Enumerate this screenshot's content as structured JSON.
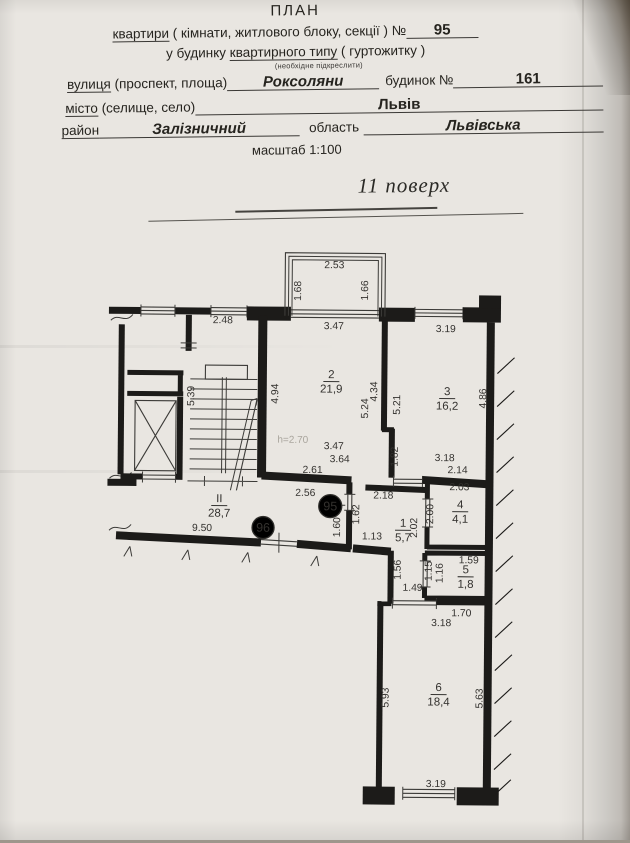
{
  "header": {
    "title": "ПЛАН",
    "apt_word": "квартири",
    "line1_rest": " ( кімнати, житлового блоку, секції ) №",
    "apartment_number": "95",
    "line2_pre": "у будинку ",
    "line2_underlined": "квартирного типу",
    "line2_post": " ( гуртожитку )",
    "line2_note": "(необхідне підкреслити)",
    "street_word": "вулиця",
    "street_label_rest": " (проспект, площа)",
    "street_value": "Роксоляни",
    "building_label": "будинок №",
    "building_value": "161",
    "city_word": "місто",
    "city_label_rest": " (селище, село)",
    "city_value": "Львів",
    "district_word": "район",
    "district_value": "Залізничний",
    "region_label": "область",
    "region_value": "Львівська",
    "scale_label": "масштаб 1:100"
  },
  "floor_title": "11 поверх",
  "plan": {
    "ceiling_height_note": "h=2.70",
    "circles": [
      {
        "t": "95",
        "x": 331,
        "y": 506,
        "r": 11.5
      },
      {
        "t": "96",
        "x": 264,
        "y": 528,
        "r": 11
      }
    ],
    "rooms": [
      {
        "num": "2",
        "area": "21,9",
        "x": 331,
        "y": 378
      },
      {
        "num": "3",
        "area": "16,2",
        "x": 447,
        "y": 394
      },
      {
        "num": "4",
        "area": "4,1",
        "x": 461,
        "y": 507
      },
      {
        "num": "1",
        "area": "5,7",
        "x": 404,
        "y": 526
      },
      {
        "num": "5",
        "area": "1,8",
        "x": 467,
        "y": 572
      },
      {
        "num": "6",
        "area": "18,4",
        "x": 441,
        "y": 690
      },
      {
        "num": "II",
        "area": "28,7",
        "x": 220,
        "y": 503
      }
    ],
    "labels": [
      {
        "t": "2.53",
        "x": 333,
        "y": 268
      },
      {
        "t": "1.68",
        "x": 300,
        "y": 291,
        "r": -90
      },
      {
        "t": "1.66",
        "x": 367,
        "y": 290,
        "r": -90
      },
      {
        "t": "2.48",
        "x": 222,
        "y": 324
      },
      {
        "t": "3.47",
        "x": 333,
        "y": 329
      },
      {
        "t": "3.19",
        "x": 445,
        "y": 331
      },
      {
        "t": "5.39",
        "x": 194,
        "y": 397,
        "r": -90
      },
      {
        "t": "4.94",
        "x": 278,
        "y": 394,
        "r": -90
      },
      {
        "t": "5.24",
        "x": 368,
        "y": 408,
        "r": -90
      },
      {
        "t": "4.34",
        "x": 377,
        "y": 391,
        "r": -90
      },
      {
        "t": "5.21",
        "x": 400,
        "y": 404,
        "r": -90
      },
      {
        "t": "h=2.70",
        "x": 293,
        "y": 443,
        "cls": "faint"
      },
      {
        "t": "3.47",
        "x": 334,
        "y": 449
      },
      {
        "t": "3.64",
        "x": 340,
        "y": 462
      },
      {
        "t": "2.61",
        "x": 313,
        "y": 473
      },
      {
        "t": "2.56",
        "x": 306,
        "y": 496
      },
      {
        "t": "4.86",
        "x": 486,
        "y": 397,
        "r": -90
      },
      {
        "t": "1.82",
        "x": 398,
        "y": 456,
        "r": -90
      },
      {
        "t": "3.18",
        "x": 445,
        "y": 460
      },
      {
        "t": "2.14",
        "x": 458,
        "y": 472
      },
      {
        "t": "2.03",
        "x": 460,
        "y": 489
      },
      {
        "t": "2.18",
        "x": 384,
        "y": 498
      },
      {
        "t": "1.62",
        "x": 360,
        "y": 514,
        "r": -90
      },
      {
        "t": "2.00",
        "x": 434,
        "y": 513,
        "r": -90
      },
      {
        "t": "2.02",
        "x": 418,
        "y": 527,
        "r": -90
      },
      {
        "t": "1.60",
        "x": 341,
        "y": 527,
        "r": -90
      },
      {
        "t": "1.13",
        "x": 373,
        "y": 539
      },
      {
        "t": "9.50",
        "x": 203,
        "y": 532
      },
      {
        "t": "1.56",
        "x": 402,
        "y": 569,
        "r": -90
      },
      {
        "t": "1.15",
        "x": 433,
        "y": 570,
        "r": -90
      },
      {
        "t": "1.16",
        "x": 444,
        "y": 572,
        "r": -90
      },
      {
        "t": "1.59",
        "x": 470,
        "y": 562
      },
      {
        "t": "1.49",
        "x": 414,
        "y": 590
      },
      {
        "t": "1.70",
        "x": 463,
        "y": 615
      },
      {
        "t": "3.18",
        "x": 443,
        "y": 625
      },
      {
        "t": "5.93",
        "x": 391,
        "y": 697,
        "r": -90
      },
      {
        "t": "5.63",
        "x": 485,
        "y": 697,
        "r": -90
      },
      {
        "t": "3.19",
        "x": 439,
        "y": 786
      }
    ]
  }
}
